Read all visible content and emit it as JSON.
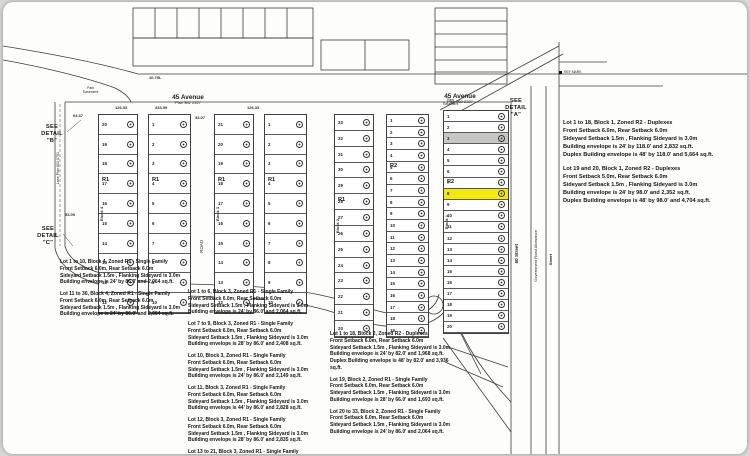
{
  "plat": {
    "streets": {
      "avenue_left": {
        "name": "45 Avenue",
        "plan": "Plan 982 2327"
      },
      "avenue_right": {
        "name": "45 Avenue",
        "plan": "Plan 982 2327"
      },
      "street_50": "50 Street",
      "gov_road": "Government Road Allowance",
      "street_right": "Street",
      "road_center": "ROAD",
      "lane_left": "Lane Plan 802 0751",
      "marker_label": "REF MARK",
      "easement_note": "Park\nEasement"
    },
    "details": {
      "a": "SEE\nDETAIL\n\"A\"",
      "b": "SEE\nDETAIL\n\"B\"",
      "c": "SEE\nDETAIL\n\"C\""
    },
    "dims": [
      "10.75L",
      "64.37",
      "53.09",
      "126.33",
      "126.33",
      "433.99",
      "33.07"
    ],
    "strips": [
      {
        "name": "block4-west",
        "x": 95,
        "y": 112,
        "w": 40,
        "h": 200,
        "lots": [
          "20",
          "19",
          "18",
          "17",
          "16",
          "15",
          "14",
          "13",
          "12",
          "11"
        ],
        "zone": "R1",
        "zoneRow": 3,
        "blockLabel": "Block 4"
      },
      {
        "name": "block4-east",
        "x": 145,
        "y": 112,
        "w": 43,
        "h": 200,
        "lots": [
          "1",
          "2",
          "3",
          "4",
          "5",
          "6",
          "7",
          "8",
          "9",
          "10"
        ],
        "zone": "R1",
        "zoneRow": 3
      },
      {
        "name": "block3-west",
        "x": 211,
        "y": 112,
        "w": 40,
        "h": 200,
        "lots": [
          "21",
          "20",
          "19",
          "18",
          "17",
          "16",
          "15",
          "14",
          "13",
          "12"
        ],
        "zone": "R1",
        "zoneRow": 3,
        "blockLabel": "Block 3"
      },
      {
        "name": "block3-east",
        "x": 261,
        "y": 112,
        "w": 43,
        "h": 200,
        "lots": [
          "1",
          "2",
          "3",
          "4",
          "5",
          "6",
          "7",
          "8",
          "9",
          "10"
        ],
        "zone": "R1",
        "zoneRow": 3
      },
      {
        "name": "block2-west",
        "x": 331,
        "y": 112,
        "w": 40,
        "h": 224,
        "lots": [
          "33",
          "32",
          "31",
          "30",
          "29",
          "28",
          "27",
          "26",
          "25",
          "24",
          "23",
          "22",
          "21",
          "20"
        ],
        "zone": "R1",
        "zoneRow": 5,
        "blockLabel": "Block 2"
      },
      {
        "name": "block2-east",
        "x": 383,
        "y": 112,
        "w": 43,
        "h": 224,
        "lots": [
          "1",
          "2",
          "3",
          "4",
          "5",
          "6",
          "7",
          "8",
          "9",
          "10",
          "11",
          "12",
          "13",
          "14",
          "15",
          "16",
          "17",
          "18",
          "19"
        ],
        "zone": "R2",
        "zoneRow": 4
      },
      {
        "name": "block1",
        "x": 440,
        "y": 108,
        "w": 66,
        "h": 224,
        "lots": [
          "1",
          "2",
          "3",
          "4",
          "5",
          "6",
          "7",
          "8",
          "9",
          "10",
          "11",
          "12",
          "13",
          "14",
          "15",
          "16",
          "17",
          "18",
          "19",
          "20"
        ],
        "zone": "R2",
        "zoneRow": 6,
        "highlightRow": 7,
        "shadedRow": 2,
        "blockLabel": "Block 1"
      }
    ],
    "notes": {
      "block1": [
        "Lot 1 to 18, Block 1, Zoned R2 - Duplexes\nFront Setback 6.0m, Rear Setback 6.0m\nSideyard Setback 1.5m , Flanking Sideyard is 3.0m\nBuilding envelope is 24' by 118.0' and 2,832 sq.ft.\nDuplex Building envelope is 48' by 118.0' and 5,664 sq.ft.",
        "Lot 19 and 20, Block 1, Zoned R2 - Duplexes\nFront Setback 5.0m, Rear Setback 6.0m\nSideyard Setback 1.5m , Flanking Sideyard is 3.0m\nBuilding envelope is 24' by 98.0' and 2,352 sq.ft.\nDuplex Building envelope is 48' by 98.0' and 4,704 sq.ft."
      ],
      "block4": [
        "Lot 1 to 10, Block 4, Zoned R1 - Single Family\nFront Setback 6.0m, Rear Setback 6.0m\nSideyard Setback 1.5m , Flanking Sideyard is 3.0m\nBuilding envelope is 24' by 86.0' and 2,064 sq.ft.",
        "Lot 11 to 30, Block 4, Zoned R1 - Single Family\nFront Setback 6.0m, Rear Setback 6.0m\nSideyard Setback 1.5m , Flanking Sideyard is 3.0m\nBuilding envelope is 24' by 86.0' and 2,064 sq.ft."
      ],
      "block3": [
        "Lot 1 to 6, Block 3, Zoned R1 - Single Family\nFront Setback 6.0m, Rear Setback 6.0m\nSideyard Setback 1.5m , Flanking Sideyard is 3.0m\nBuilding envelope is 24' by 86.0' and 2,064 sq.ft.",
        "Lot 7 to 9, Block 3, Zoned R1 - Single Family\nFront Setback 6.0m, Rear Setback 6.0m\nSideyard Setback 1.5m , Flanking Sideyard is 3.0m\nBuilding envelope is 28' by 86.0' and 2,408 sq.ft.",
        "Lot 10, Block 3, Zoned R1 - Single Family\nFront Setback 6.0m, Rear Setback 6.0m\nSideyard Setback 1.5m , Flanking Sideyard is 3.0m\nBuilding envelope is 24' by 86.0' and 2,149 sq.ft.",
        "Lot 11, Block 3, Zoned R1 - Single Family\nFront Setback 6.0m, Rear Setback 6.0m\nSideyard Setback 1.5m , Flanking Sideyard is 3.0m\nBuilding envelope is 44' by 86.0' and 2,828 sq.ft.",
        "Lot 12, Block 3, Zoned R1 - Single Family\nFront Setback 6.0m, Rear Setback 6.0m\nSideyard Setback 1.5m , Flanking Sideyard is 3.0m\nBuilding envelope is 28' by 86.0' and 2,835 sq.ft.",
        "Lot 13 to 21, Block 3, Zoned R1 - Single Family\nFront Setback 6.0m, Rear Setback 6.0m\nSideyard Setback 1.5m , Flanking Sideyard is 3.0m"
      ],
      "block2": [
        "Lot 1 to 18, Block 2, Zoned R2 - Duplexes\nFront Setback 6.0m, Rear Setback 6.0m\nSideyard Setback 1.5m , Flanking Sideyard is 3.0m\nBuilding envelope is 24' by 82.0' and 1,968 sq.ft.\nDuplex Building envelope is 48' by 82.0' and 3,936 sq.ft.",
        "Lot 19, Block 2, Zoned R1 - Single Family\nFront Setback 6.0m, Rear Setback 6.0m\nSideyard Setback 1.5m , Flanking Sideyard is 3.0m\nBuilding envelope is 28' by 66.0' and 1,693 sq.ft.",
        "Lot 20 to 33, Block 2, Zoned R1 - Single Family\nFront Setback 6.0m, Rear Setback 6.0m\nSideyard Setback 1.5m , Flanking Sideyard is 3.0m\nBuilding envelope is 24' by 86.0' and 2,064 sq.ft."
      ]
    },
    "colors": {
      "highlight": "#f4e90e",
      "line": "#3c3c3c",
      "paper": "#fdfdfb"
    }
  }
}
